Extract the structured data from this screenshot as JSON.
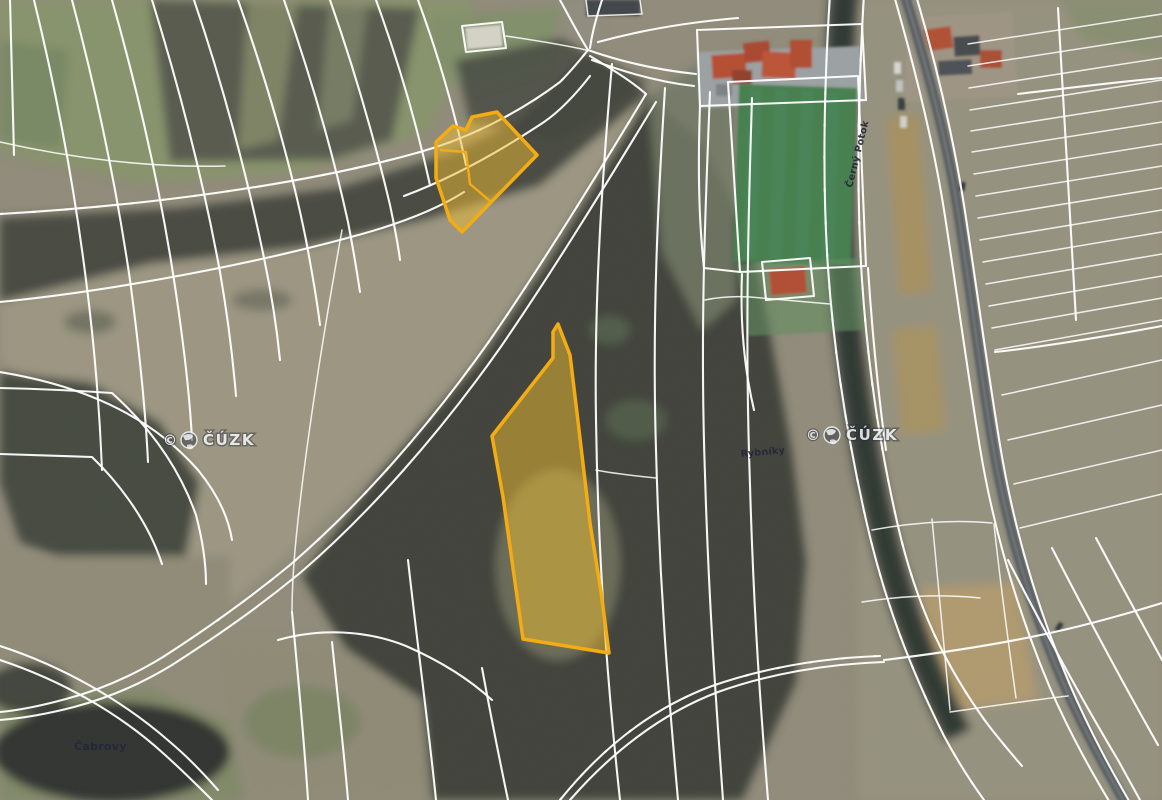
{
  "map": {
    "type": "cadastral-parcel-overlay-on-orthophoto",
    "watermarks": [
      {
        "symbol": "©",
        "org": "ČÚZK",
        "transform": "translate(163,445)"
      },
      {
        "symbol": "©",
        "org": "ČÚZK",
        "transform": "translate(806,440)"
      }
    ],
    "place_labels": [
      {
        "text": "Čabrovy",
        "transform": "translate(74,750)"
      },
      {
        "text": "Rybníky",
        "transform": "translate(741,457) rotate(-5)"
      },
      {
        "text": "Černý Potok",
        "transform": "translate(852,188) rotate(-76)"
      }
    ],
    "highlighted_parcels": {
      "fill": "#edbb31",
      "fill_opacity": "0.5",
      "stroke": "#f3ac14",
      "stroke_width": "3.5",
      "inner_stroke_width": "2.4",
      "parcels": [
        {
          "name": "north-parcel",
          "points": "497,112 537,155 462,232 450,220 436,178 436,142 453,126 466,130 472,117",
          "inner_points": "440,150 466,152 470,184 490,201"
        },
        {
          "name": "south-parcel",
          "points": "558,324 570,355 577,413 590,523 601,592 609,653 523,639 503,497 492,436 553,358 553,332"
        }
      ]
    },
    "boundary_line_color": "#ffffff"
  }
}
